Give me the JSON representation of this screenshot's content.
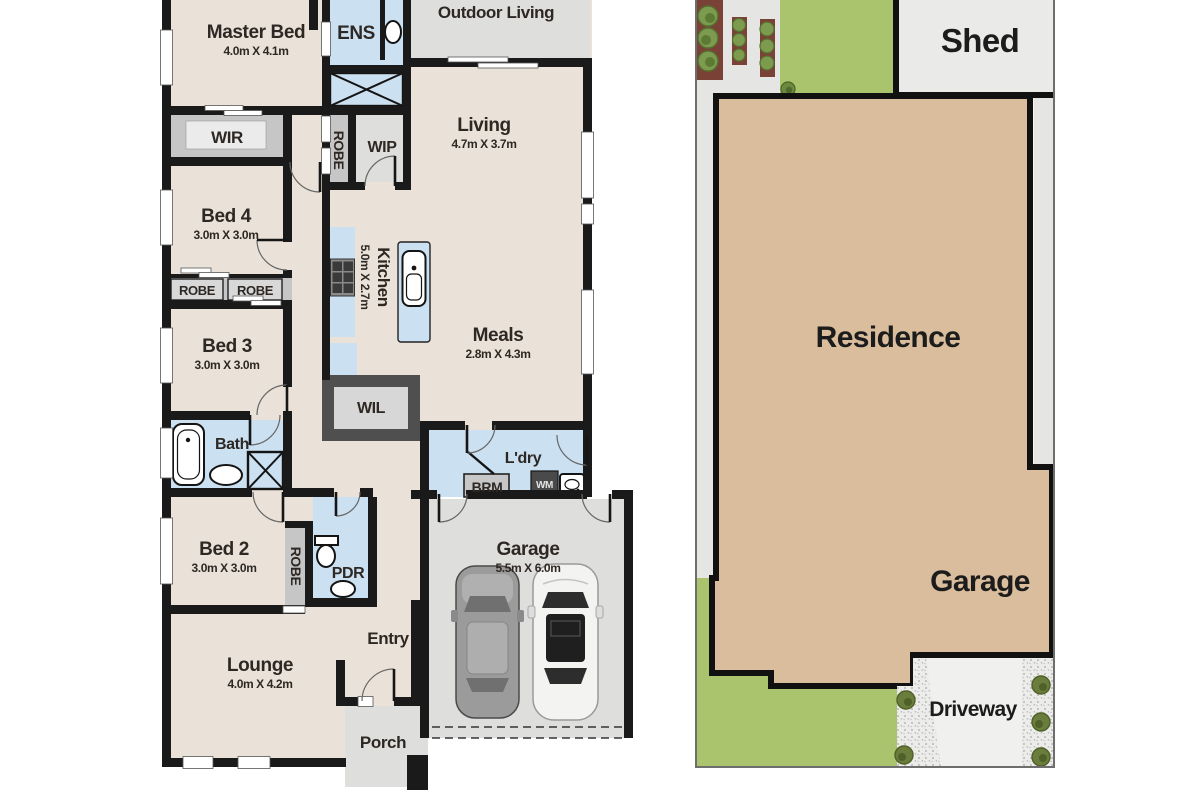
{
  "floorplan": {
    "rooms": {
      "outdoor_living": {
        "label": "Outdoor Living"
      },
      "master_bed": {
        "label": "Master Bed",
        "dims": "4.0m X 4.1m"
      },
      "ens": {
        "label": "ENS"
      },
      "wir": {
        "label": "WIR"
      },
      "robe_hall": {
        "label": "ROBE"
      },
      "wip": {
        "label": "WIP"
      },
      "living": {
        "label": "Living",
        "dims": "4.7m X 3.7m"
      },
      "bed4": {
        "label": "Bed 4",
        "dims": "3.0m X 3.0m"
      },
      "robe_bed4": {
        "label": "ROBE"
      },
      "robe_bed3": {
        "label": "ROBE"
      },
      "bed3": {
        "label": "Bed 3",
        "dims": "3.0m X 3.0m"
      },
      "kitchen": {
        "label": "Kitchen",
        "dims": "5.0m X 2.7m"
      },
      "meals": {
        "label": "Meals",
        "dims": "2.8m X 4.3m"
      },
      "wil": {
        "label": "WIL"
      },
      "bath": {
        "label": "Bath"
      },
      "ldry": {
        "label": "L'dry"
      },
      "brm": {
        "label": "BRM"
      },
      "wm": {
        "label": "WM"
      },
      "bed2": {
        "label": "Bed 2",
        "dims": "3.0m X 3.0m"
      },
      "robe_bed2": {
        "label": "ROBE"
      },
      "pdr": {
        "label": "PDR"
      },
      "garage": {
        "label": "Garage",
        "dims": "5.5m X 6.0m"
      },
      "entry": {
        "label": "Entry"
      },
      "lounge": {
        "label": "Lounge",
        "dims": "4.0m X 4.2m"
      },
      "porch": {
        "label": "Porch"
      }
    },
    "colors": {
      "floor": "#EAE2D8",
      "wet_area": "#CBE0F1",
      "outdoor": "#DEDEDD",
      "storage": "#C6C6C6",
      "wall": "#1A1A1A"
    }
  },
  "siteplan": {
    "labels": {
      "shed": "Shed",
      "residence": "Residence",
      "garage": "Garage",
      "driveway": "Driveway"
    },
    "colors": {
      "residence": "#D9BD9C",
      "lawn": "#A9C46C",
      "garden_bed": "#7A4136",
      "shed": "#EAEAE8",
      "path": "#E5E5E3",
      "driveway": "#F0F0EE"
    }
  }
}
